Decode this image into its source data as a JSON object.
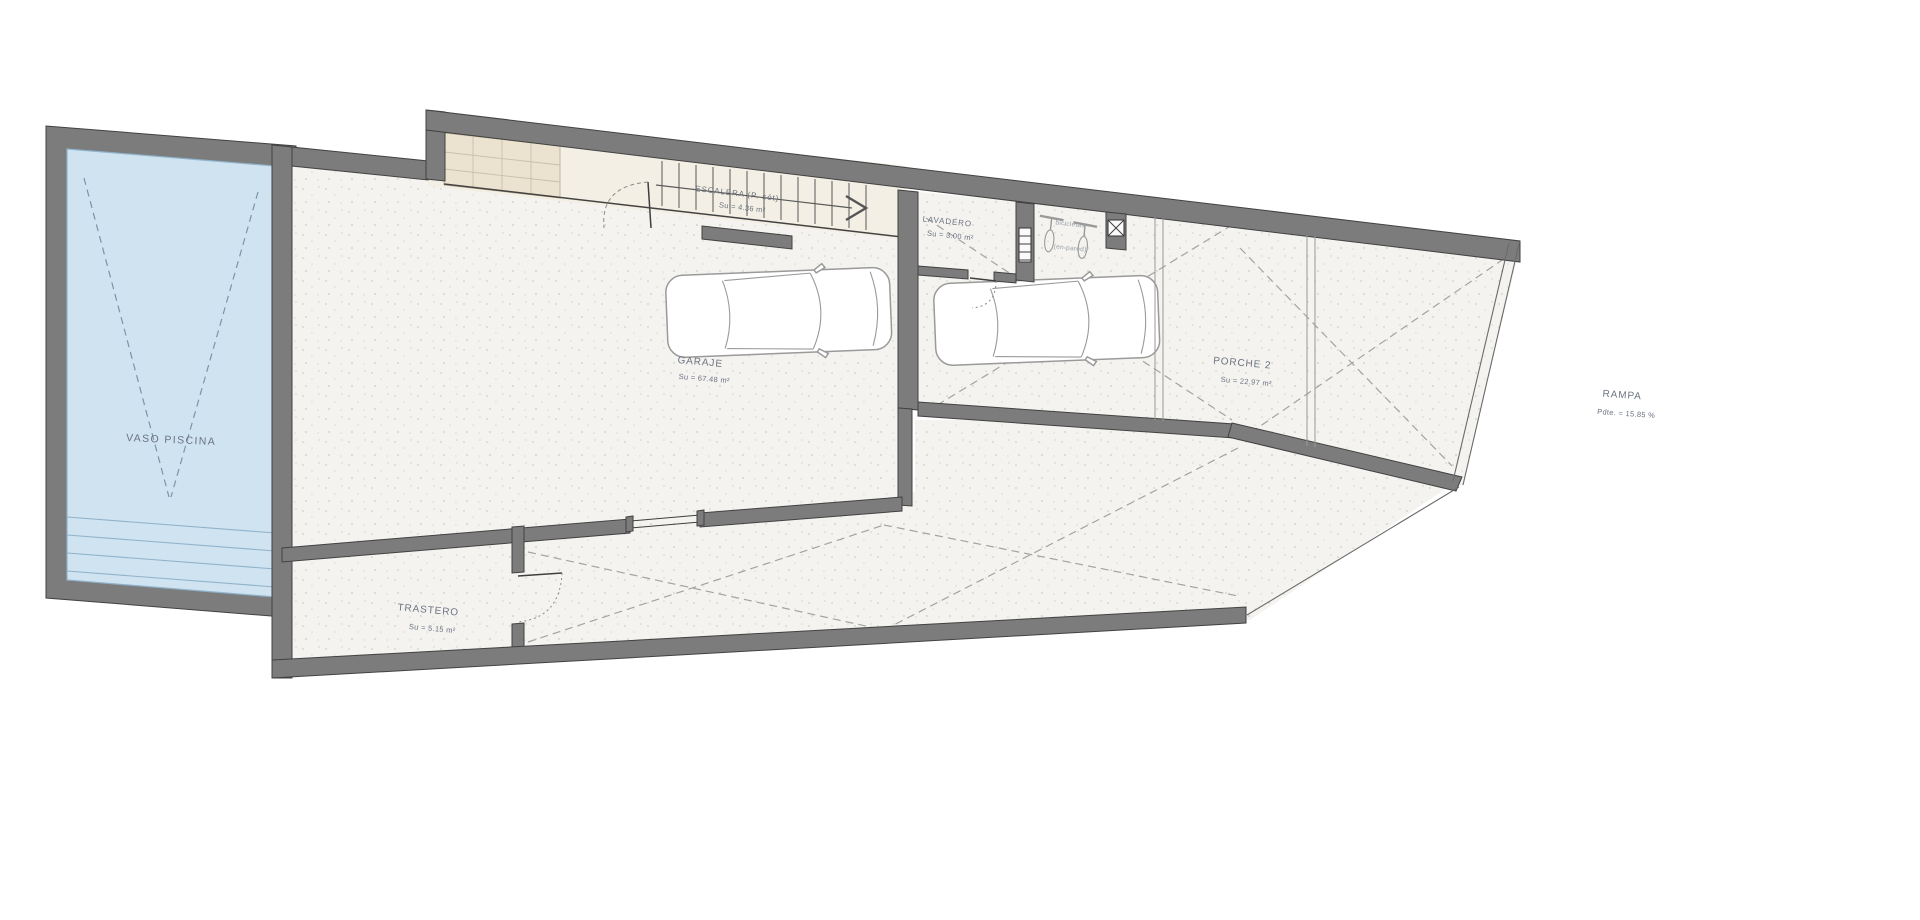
{
  "plan": {
    "pool": {
      "label": "VASO PISCINA"
    },
    "rooms": {
      "escalera": {
        "name": "ESCALERA (P. sót)",
        "area": "Su = 4.36 m²"
      },
      "lavadero": {
        "name": "LAVADERO",
        "area": "Su = 3.00 m²"
      },
      "bicis": {
        "line1": "bicicletas",
        "line2": "(en pared)"
      },
      "garaje": {
        "name": "GARAJE",
        "area": "Su = 67.48 m²"
      },
      "porche": {
        "name": "PORCHE 2",
        "area": "Su = 22.97 m²"
      },
      "rampa": {
        "name": "RAMPA",
        "area": "Pdte. = 15.85 %"
      },
      "trastero": {
        "name": "TRASTERO",
        "area": "Su = 5.15 m²"
      }
    }
  },
  "colors": {
    "wall": "#7c7c7c",
    "wallStroke": "#424242",
    "floor": "#f4f3f0",
    "floorDot": "#dbdad3",
    "beige": "#f3efe4",
    "beigeDark": "#ebe2d0",
    "water": "#cfe3f1",
    "waterLine": "#8fb2ca",
    "label": "#6b7280",
    "dash": "#a3a3a3",
    "carStroke": "#9a9a9a"
  }
}
